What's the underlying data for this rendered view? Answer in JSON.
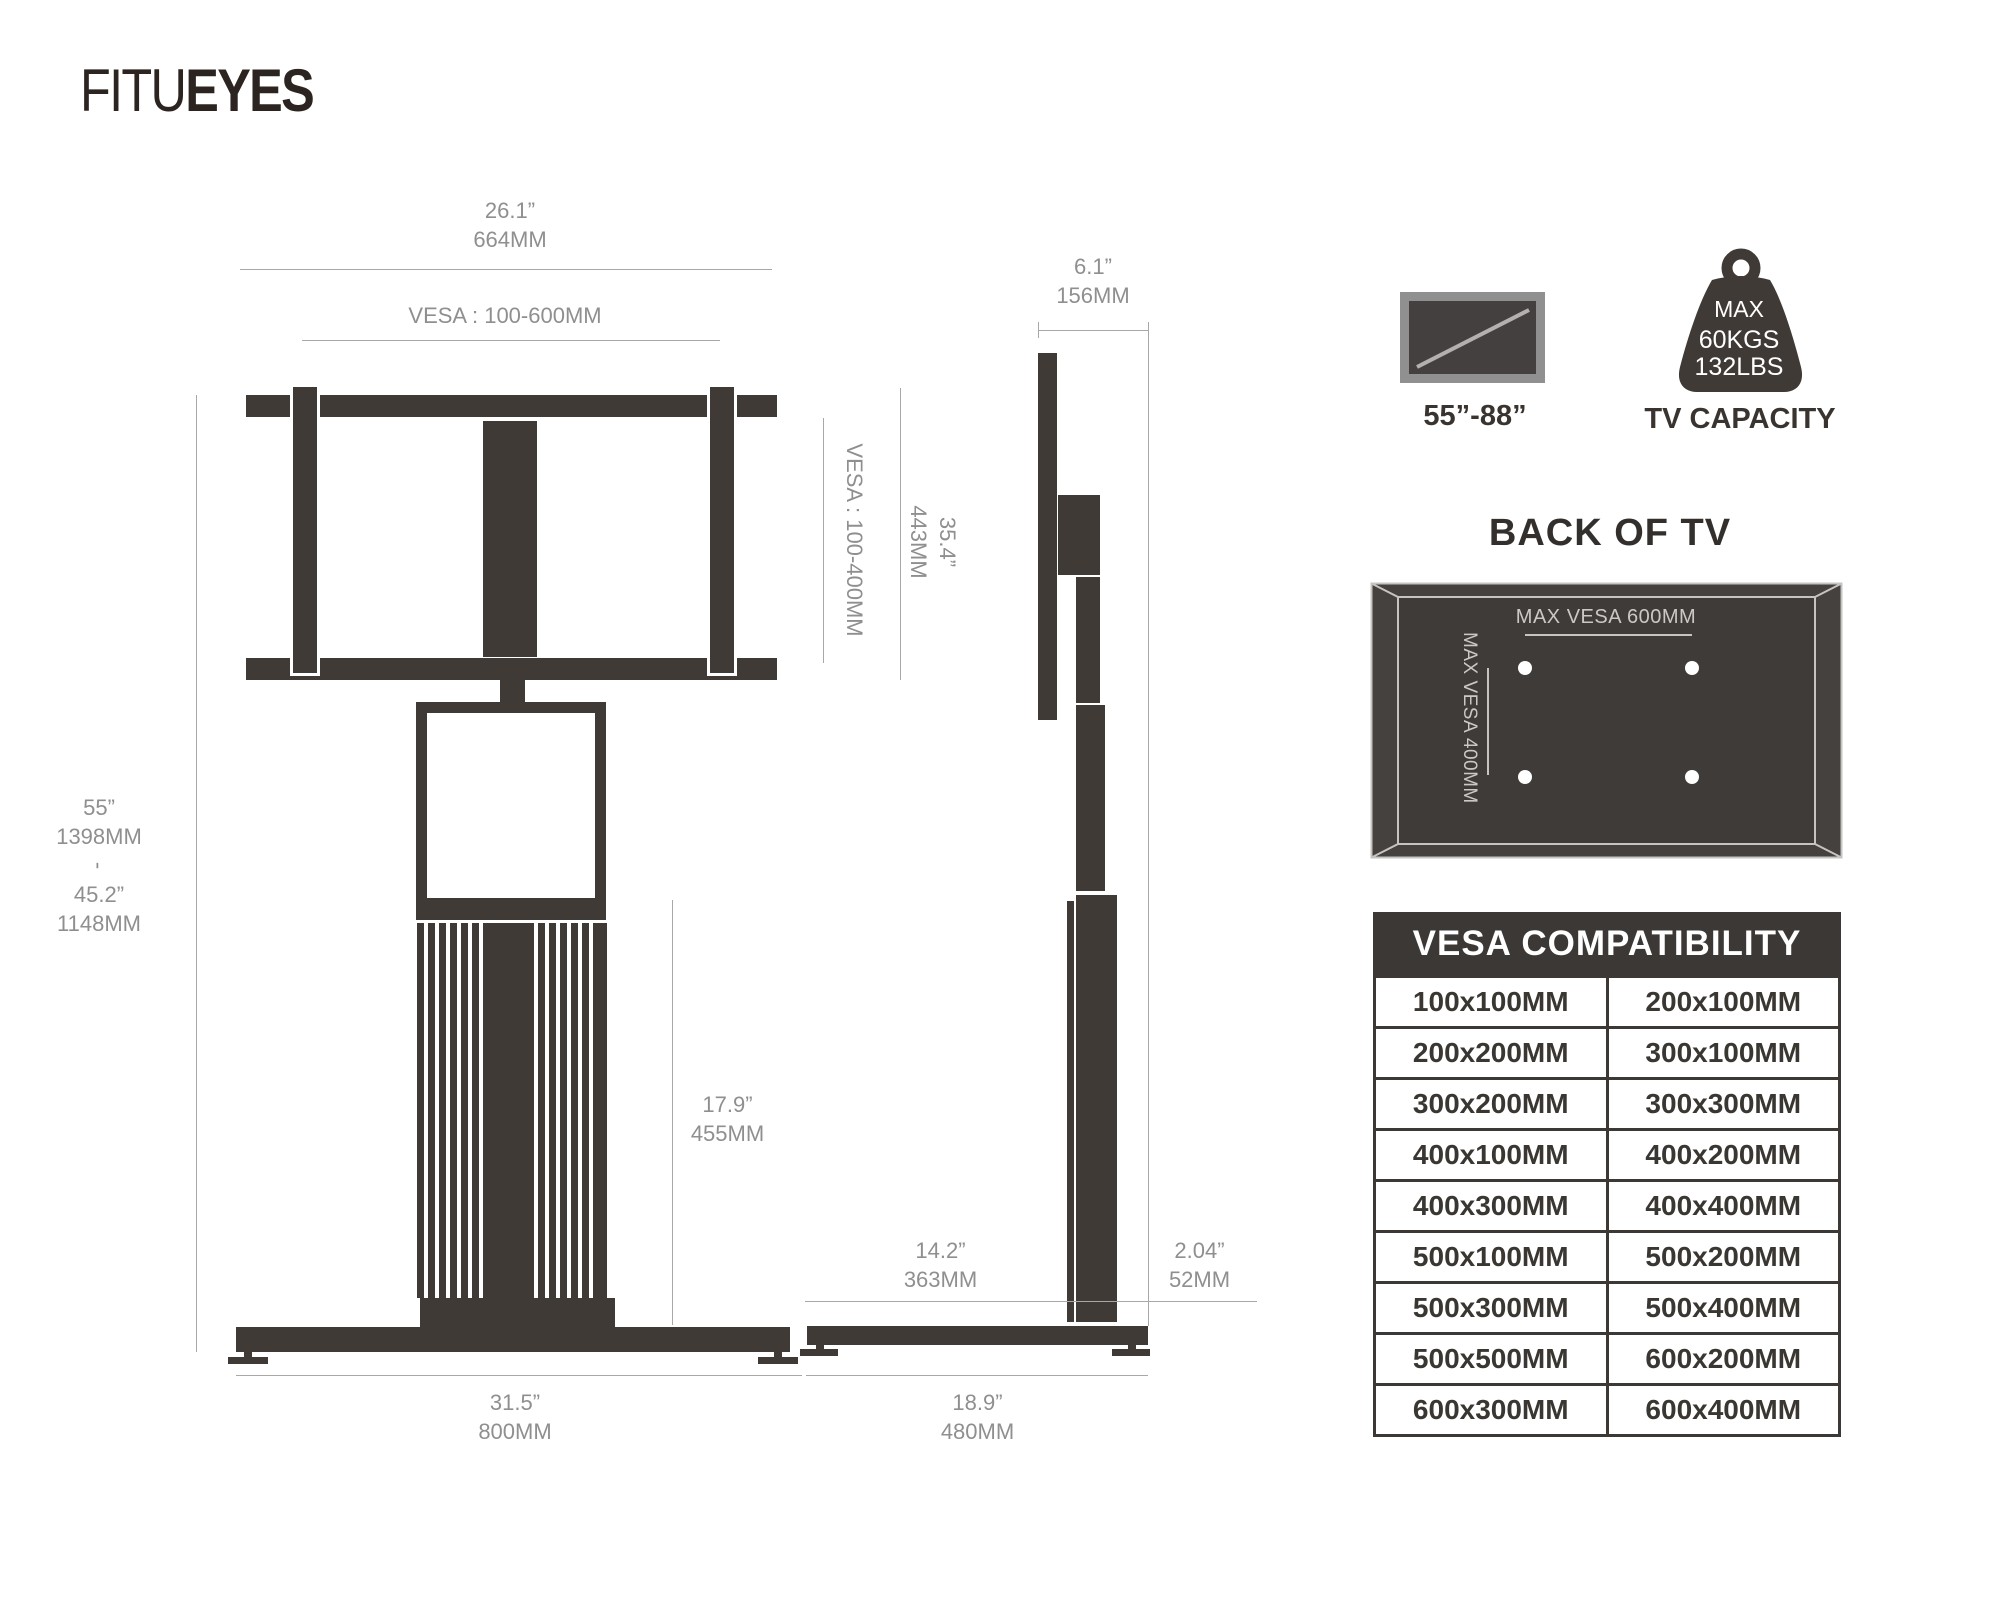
{
  "logo": {
    "part1": "FITU",
    "part2": "EYES"
  },
  "front_view": {
    "width_in": "26.1”",
    "width_mm": "664MM",
    "vesa_range": "VESA : 100-600MM",
    "height_max_in": "55”",
    "height_max_mm": "1398MM",
    "height_sep": "-",
    "height_min_in": "45.2”",
    "height_min_mm": "1148MM",
    "column_in": "17.9”",
    "column_mm": "455MM",
    "base_in": "31.5”",
    "base_mm": "800MM"
  },
  "side_view": {
    "depth_top_in": "6.1”",
    "depth_top_mm": "156MM",
    "vesa_range_vertical": "VESA : 100-400MM",
    "mount_height_in": "35.4”",
    "mount_height_mm": "443MM",
    "base_front_in": "14.2”",
    "base_front_mm": "363MM",
    "column_depth_in": "2.04”",
    "column_depth_mm": "52MM",
    "base_depth_in": "18.9”",
    "base_depth_mm": "480MM"
  },
  "badges": {
    "tv_size_label": "55”-88”",
    "capacity_line1": "MAX",
    "capacity_line2": "60KGS",
    "capacity_line3": "132LBS",
    "capacity_label": "TV CAPACITY"
  },
  "back_of_tv": {
    "title": "BACK OF TV",
    "max_vesa_horizontal": "MAX VESA 600MM",
    "max_vesa_vertical": "MAX VESA 400MM"
  },
  "vesa_table": {
    "title": "VESA COMPATIBILITY",
    "rows": [
      [
        "100x100MM",
        "200x100MM"
      ],
      [
        "200x200MM",
        "300x100MM"
      ],
      [
        "300x200MM",
        "300x300MM"
      ],
      [
        "400x100MM",
        "400x200MM"
      ],
      [
        "400x300MM",
        "400x400MM"
      ],
      [
        "500x100MM",
        "500x200MM"
      ],
      [
        "500x300MM",
        "500x400MM"
      ],
      [
        "500x500MM",
        "600x200MM"
      ],
      [
        "600x300MM",
        "600x400MM"
      ]
    ]
  },
  "colors": {
    "ink": "#3f3a36",
    "logo": "#2c2420",
    "dim_text": "#8f8f8f",
    "dim_line": "#a8a8a8",
    "tv_bezel": "#909090",
    "tv_screen": "#454040",
    "panel_outer": "#45413e",
    "panel_inner": "#3f3b38",
    "panel_line": "#c6c4c2",
    "panel_text": "#cbc9c7",
    "table_header_bg": "#3c3835",
    "table_text": "#3a3632",
    "white": "#ffffff"
  }
}
